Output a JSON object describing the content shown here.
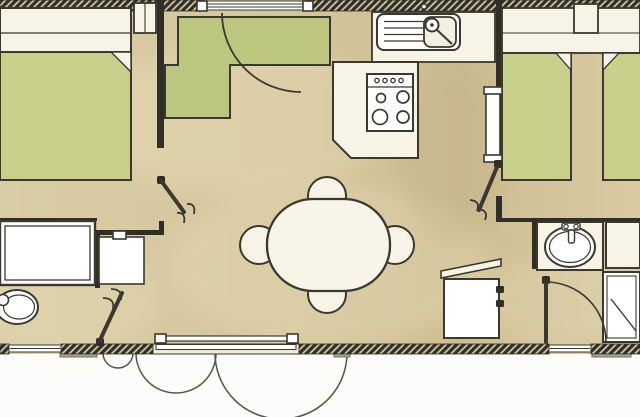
{
  "app": {
    "type": "floor-plan-image",
    "description": "Top-down architectural floor plan of a mobile home; graphic symbols only, no visible text"
  },
  "colors": {
    "floor": "#d6c79e",
    "floorLight": "#ebe2be",
    "floorShadow": "#c2b188",
    "outside": "#fcfcfa",
    "wall": "#2f2e27",
    "hatchBg": "#cfc5a2",
    "line": "#3a382f",
    "cream": "#f7f3e6",
    "white": "#ffffff",
    "bedGreen": "#c8d08c",
    "bedGreenDeep": "#bcc67f",
    "stepGray": "#a9a69d",
    "arcLine": "#55534b"
  },
  "rooms": [
    {
      "name": "master-bedroom",
      "items": [
        "double-bed",
        "nightstand",
        "hinged-door"
      ]
    },
    {
      "name": "kids-bedroom",
      "items": [
        "l-shaped-bed",
        "door-swing-arc",
        "window"
      ]
    },
    {
      "name": "kitchen",
      "items": [
        "sink-unit",
        "four-burner-stove",
        "counter-peninsula"
      ]
    },
    {
      "name": "living-dining",
      "items": [
        "oval-table",
        "chair",
        "chair",
        "chair",
        "chair",
        "sliding-patio-door"
      ]
    },
    {
      "name": "twin-bedroom",
      "items": [
        "twin-bed",
        "twin-bed",
        "nightstand",
        "wardrobe",
        "hinged-door"
      ]
    },
    {
      "name": "shower-room",
      "items": [
        "washbasin",
        "shower",
        "side-cabinet",
        "hinged-door",
        "open-lid-cabinet"
      ]
    },
    {
      "name": "wc",
      "items": [
        "toilet",
        "bathtub",
        "vanity-unit",
        "hinged-door"
      ]
    }
  ]
}
